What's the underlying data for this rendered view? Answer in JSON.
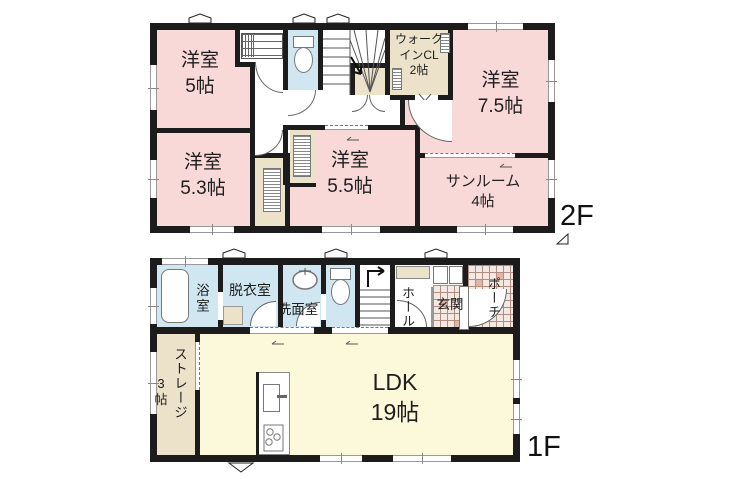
{
  "palette": {
    "wall": "#1c1c1c",
    "room_pink": "#f8d9d8",
    "wet_area_blue": "#d0e7f2",
    "closet_beige": "#ebe2c9",
    "ldk_yellow": "#fcf9da",
    "tile_base": "#f3e9e2",
    "tile_accent": "#e3b5a7",
    "window_gray": "#999999"
  },
  "floor2": {
    "tag": "2F",
    "rooms": {
      "room5": "洋室\n5帖",
      "wicl": "ウォーク\nインCL\n2帖",
      "room75": "洋室\n7.5帖",
      "room53": "洋室\n5.3帖",
      "room55": "洋室\n5.5帖",
      "sunroom": "サンルーム\n4帖"
    }
  },
  "floor1": {
    "tag": "1F",
    "rooms": {
      "bath": "浴室",
      "dressing": "脱衣室",
      "washroom": "洗面室",
      "hall": "ホール",
      "entrance": "玄関",
      "porch": "ポーチ",
      "storage": "ストレージ",
      "storage_size": "3\n帖",
      "ldk": "LDK\n19帖"
    }
  }
}
